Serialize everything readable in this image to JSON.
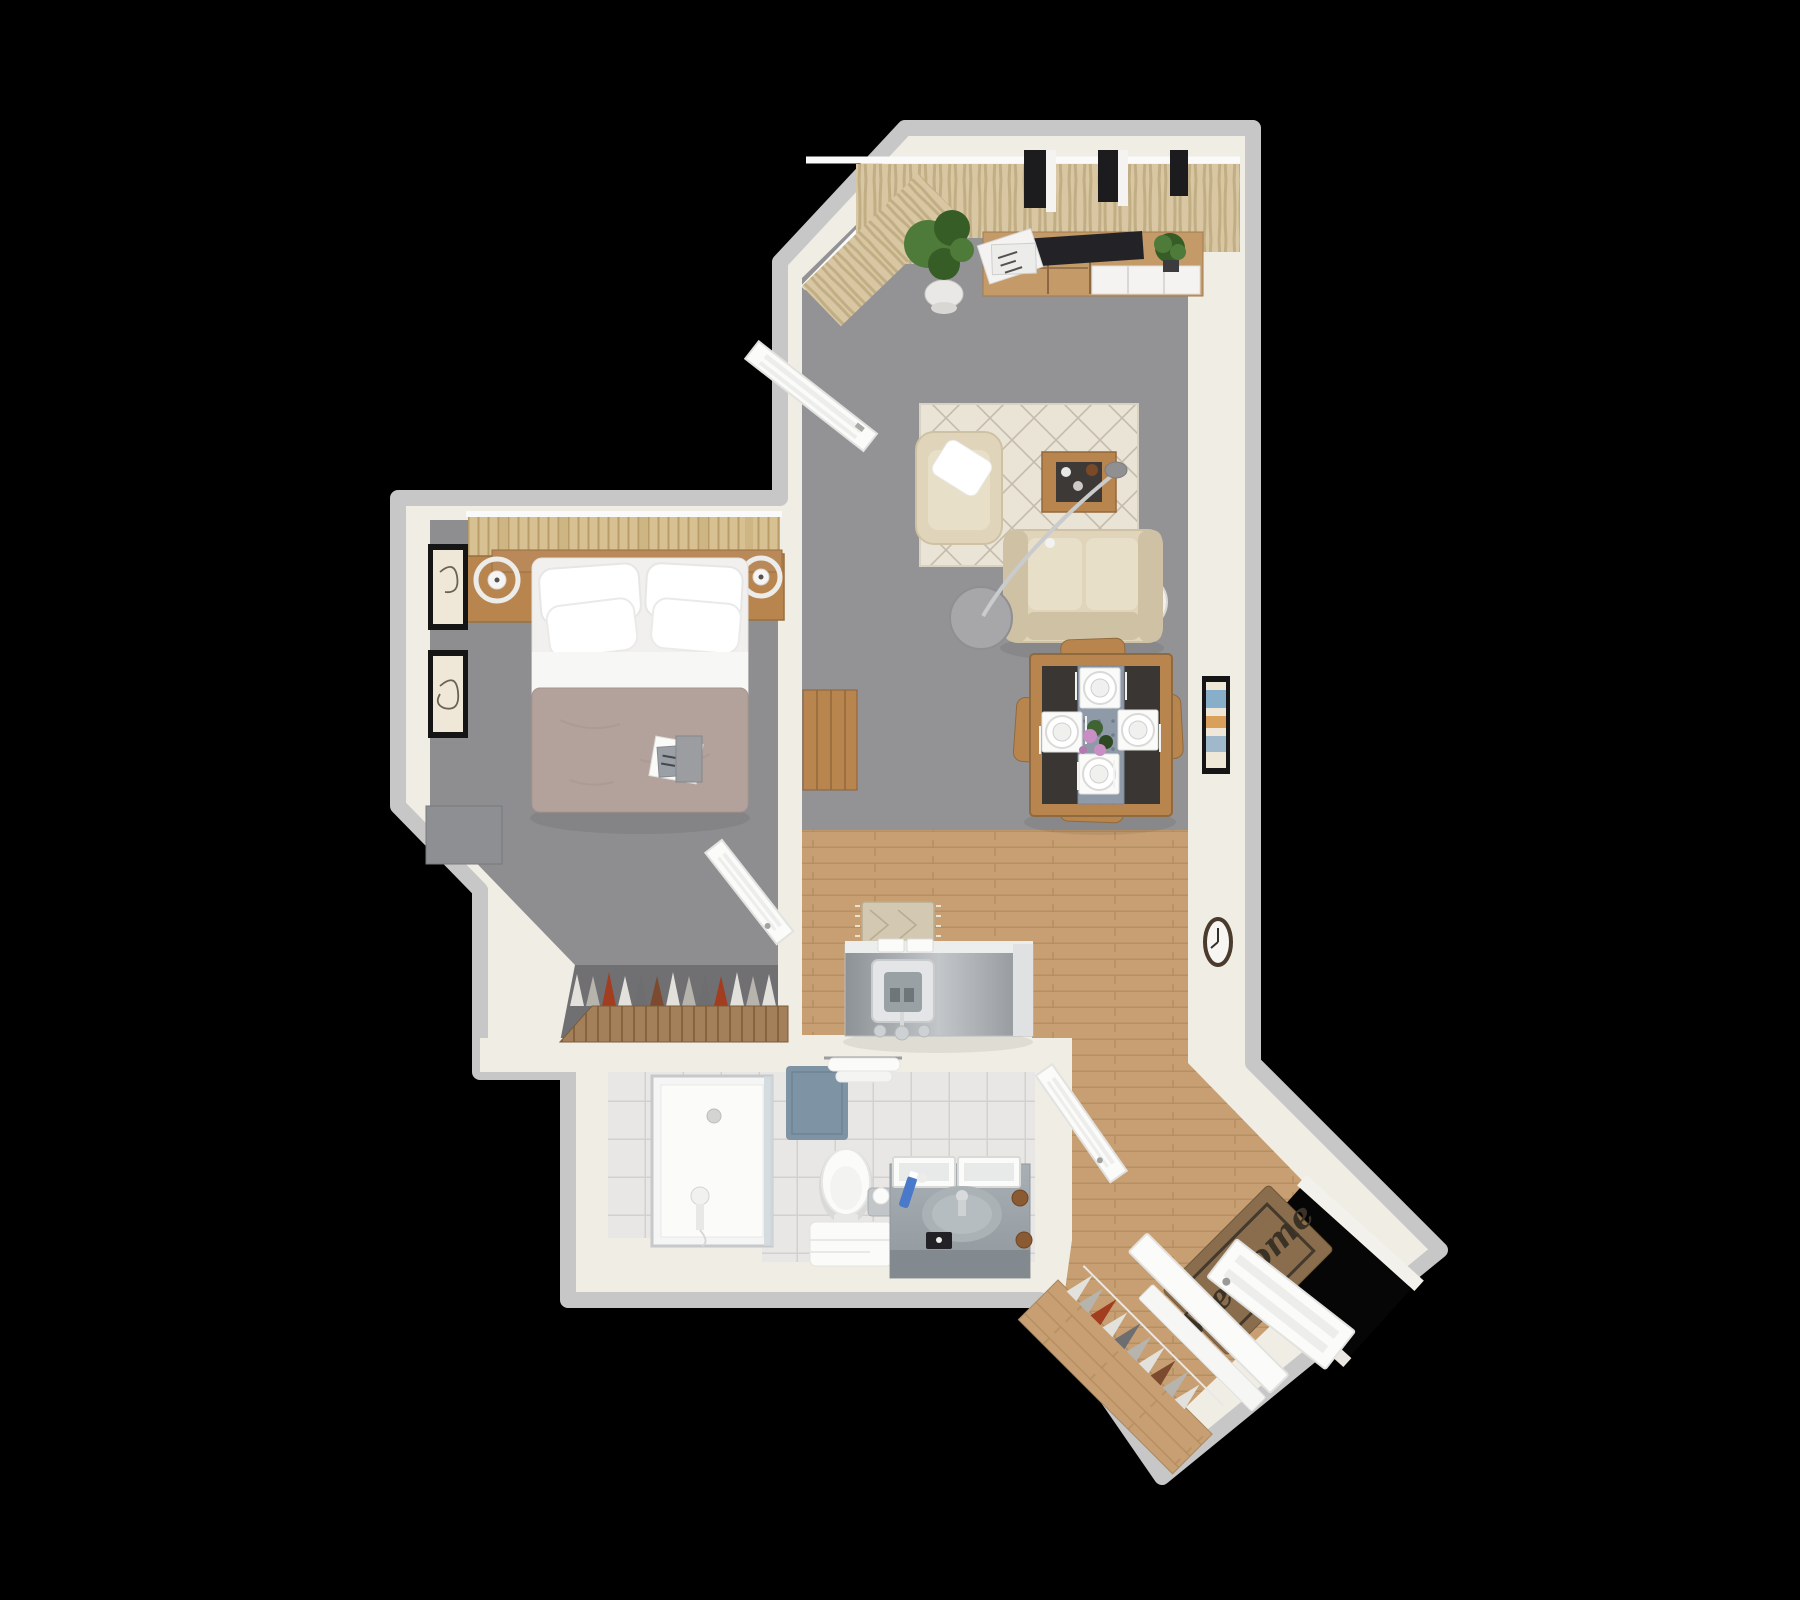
{
  "entry": {
    "welcome_mat_text": "Welcome"
  },
  "colors": {
    "bg": "#000000",
    "wallFace": "#f0ede5",
    "wallEdge": "#c7c7c7",
    "carpetLiving": "#939396",
    "carpetBed": "#8e8e91",
    "closetFloor": "#707073",
    "woodFloor": "#c79f72",
    "woodLine": "#b08a5c",
    "furnWood": "#b9854f",
    "furnWoodDark": "#8f6a3e",
    "tile": "#e8e7e5",
    "tileLine": "#d2d1ce",
    "cream": "#e0d5ba",
    "creamDark": "#cfc2a4",
    "creamLight": "#e8dfc8",
    "rug": "#eae4d6",
    "rugLine": "#9c9280",
    "duvet": "#b3a29b",
    "duvetLine": "#a5948c",
    "tv": "#232327",
    "tableTop": "#3a3633",
    "runner": "#8e9aa8",
    "blueMat": "#7e93a3",
    "matBrown": "#8a6d4c",
    "matInk": "#3b3226",
    "plant": "#4e7b3a",
    "plantDark": "#375d27",
    "flower": "#c98fc4",
    "metal": "#c9cbcd",
    "curtain": "#d8c7a2",
    "curtainLine": "#c2ae85",
    "slat": "#d7c193",
    "slatLine": "#b89d69",
    "wardrobe": "#a3805a",
    "wardrobeLine": "#86643f",
    "white": "#ffffff",
    "offWhite": "#f4f3f1",
    "doorWhite": "#fbfbfa",
    "doorEdge": "#e2e2e0",
    "panelLine": "#ededeb",
    "glass": "#cfd7db",
    "counterA": "#c2c6c9",
    "counterB": "#8d9296",
    "vanityA": "#a8b0b5",
    "vanityB": "#8f979c",
    "vanityFront": "#828a90",
    "grayFurn": "#8d8f92",
    "artFrame": "#151515",
    "artPaper": "#efe8d8",
    "artInk": "#6b6257",
    "windowDark": "#1c1c1e",
    "voidBlack": "#060606",
    "clothes1": "#e3e1dc",
    "clothes2": "#b7b4ae",
    "clothes3": "#a23d20",
    "clothes4": "#6e6e71",
    "clothes5": "#7c4a2e",
    "tooth": "#4a79c9",
    "soap": "#8a5a33",
    "boxBlack": "#222226"
  }
}
